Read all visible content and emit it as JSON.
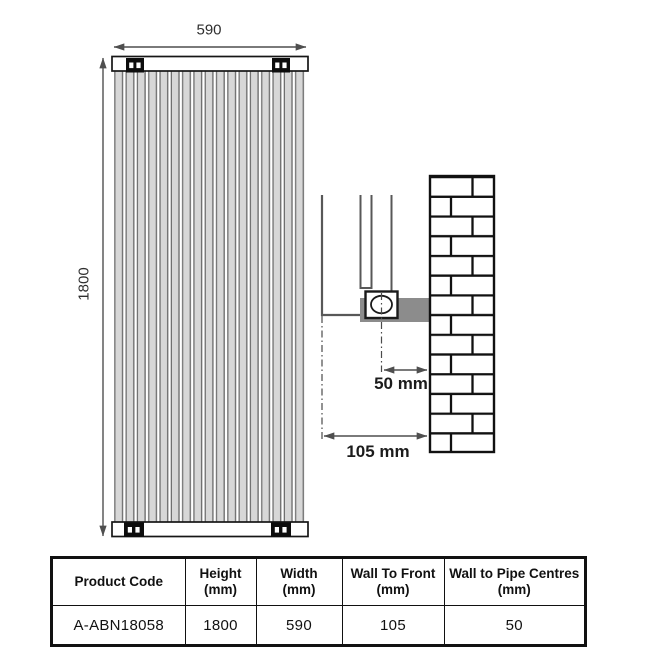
{
  "front_view": {
    "width_label": "590",
    "height_label": "1800"
  },
  "side_view": {
    "pipe_centres_label": "50 mm",
    "wall_to_front_label": "105 mm"
  },
  "spec_table": {
    "columns": [
      {
        "label": "Product Code",
        "unit": ""
      },
      {
        "label": "Height",
        "unit": "(mm)"
      },
      {
        "label": "Width",
        "unit": "(mm)"
      },
      {
        "label": "Wall To Front",
        "unit": "(mm)"
      },
      {
        "label": "Wall to Pipe Centres",
        "unit": "(mm)"
      }
    ],
    "rows": [
      {
        "product_code": "A-ABN18058",
        "height": "1800",
        "width": "590",
        "wall_to_front": "105",
        "wall_to_pipe_centres": "50"
      }
    ]
  },
  "colors": {
    "dimension_line": "#4f4f4f",
    "outline": "#161616",
    "tube_fill": "#d7d7d7",
    "tube_edge": "#6e6e6e",
    "bracket_gray": "#8c8c8c",
    "table_border": "#111111",
    "text": "#1f1f1f"
  }
}
